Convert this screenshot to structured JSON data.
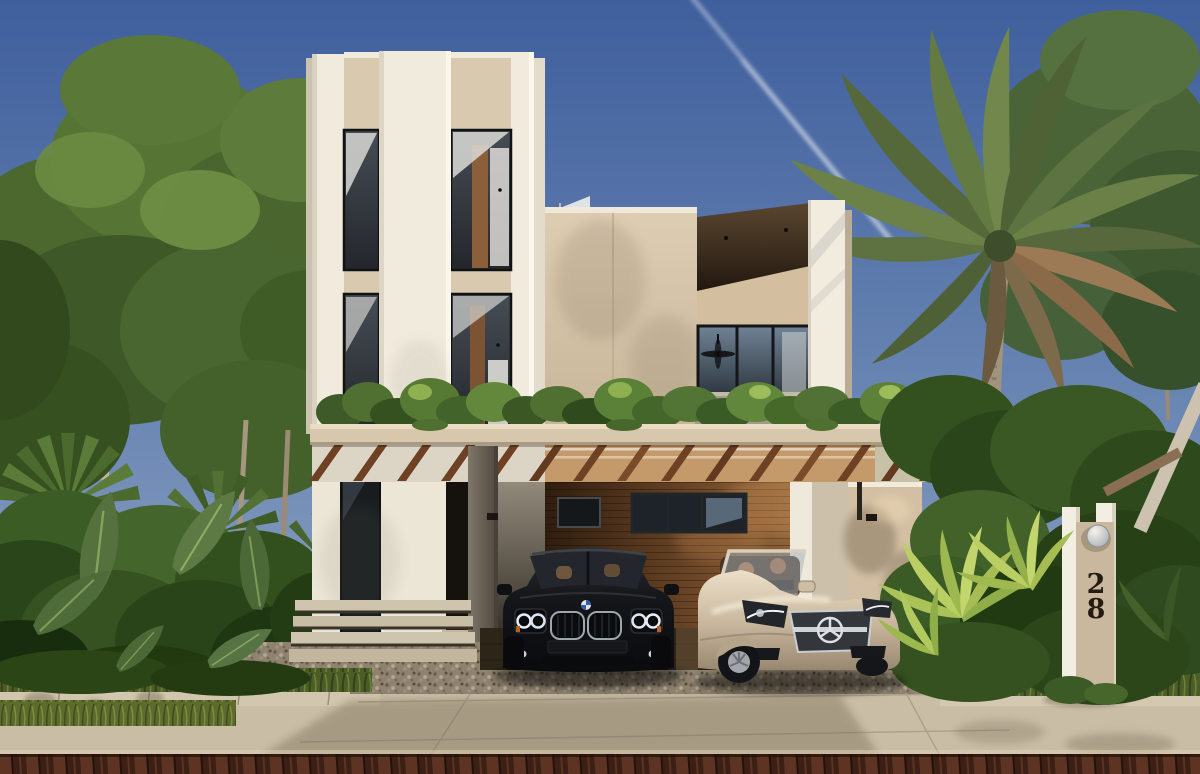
{
  "scene": {
    "type": "exterior architectural rendering",
    "description": "Modern three-storey white-and-beige tropical villa with a slatted wood carport pergola, two cars parked beneath it (a black BMW sedan and a champagne Mercedes convertible), dense palm landscaping on both sides, a concrete driveway, brick street, and an address monument",
    "lighting": "late afternoon sun from the right, clear blue sky with one jet contrail",
    "address": {
      "digits": [
        "2",
        "8"
      ]
    },
    "vehicles": [
      {
        "name": "black-bmw-sedan",
        "body_color": "#121114",
        "position": "left carport bay"
      },
      {
        "name": "champagne-mercedes-convertible",
        "body_color": "#cbbaa1",
        "position": "right carport bay"
      }
    ],
    "palette": {
      "sky_top": "#3f5f9d",
      "sky_horizon": "#93a7c5",
      "facade_white": "#f1ebdd",
      "facade_beige": "#d9c9af",
      "pergola_wood": "#6e4124",
      "garage_wood": "#8a5f38",
      "window_glass": "#2a3138",
      "foliage_dark": "#2c441f",
      "foliage_bright": "#a9c155",
      "concrete": "#c9bda5",
      "gravel": "#8e8270",
      "road_brick": "#3c2016",
      "contrail": "#ffffff",
      "address_light_metal": "#c9cdd1"
    }
  }
}
